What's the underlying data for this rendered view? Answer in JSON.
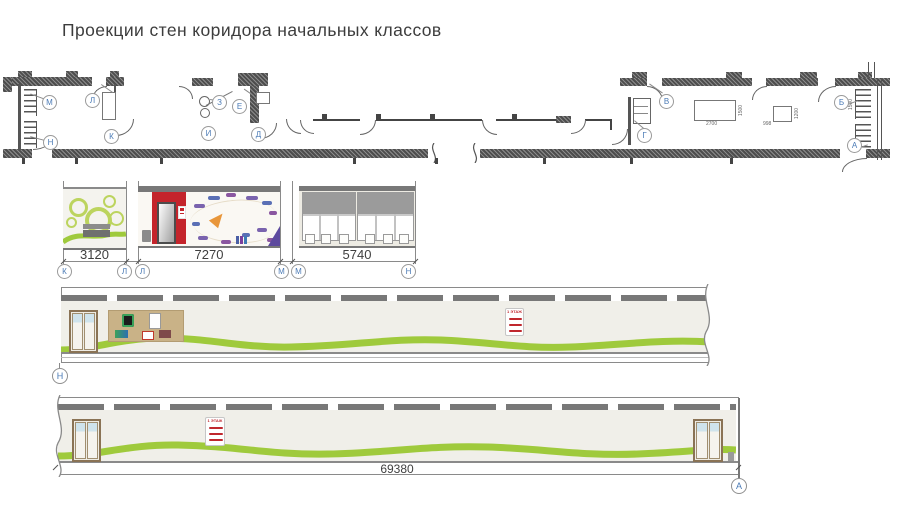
{
  "title": "Проекции стен коридора начальных классов",
  "plan": {
    "markers": [
      "М",
      "Н",
      "Л",
      "К",
      "З",
      "И",
      "Е",
      "Д",
      "В",
      "Г",
      "Б",
      "А"
    ],
    "dims": {
      "cabinet_width": "2700",
      "cabinet_height": "1500",
      "stand_width": "998",
      "stand_height": "1200",
      "radiator_length": "1500"
    }
  },
  "elevations": {
    "panels": [
      {
        "dim": "3120"
      },
      {
        "dim": "7270"
      },
      {
        "dim": "5740"
      }
    ],
    "markers": [
      "К",
      "Л",
      "Л",
      "М",
      "М",
      "Н"
    ]
  },
  "corridor_upper": {
    "marker": "Н",
    "sign": "1 ЭТАЖ"
  },
  "corridor_lower": {
    "marker": "А",
    "sign": "1 ЭТАЖ",
    "total_dim": "69380"
  },
  "colors": {
    "accent_green": "#9fca3c",
    "wall_red": "#c4242b",
    "marker_blue": "#4a7ab5"
  }
}
